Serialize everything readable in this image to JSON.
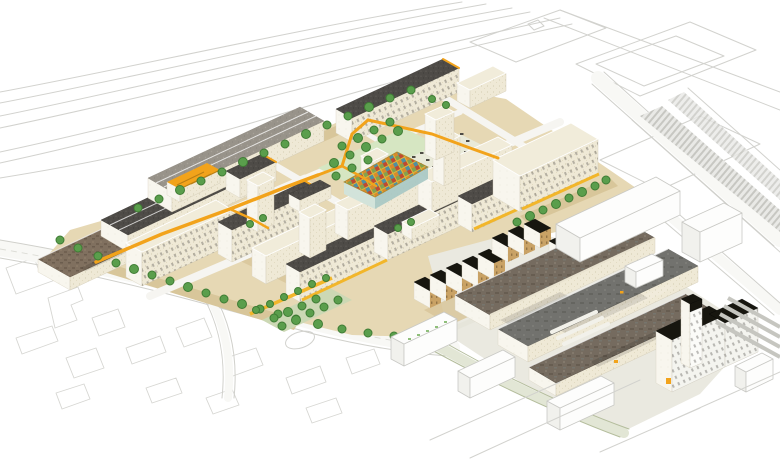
{
  "meta": {
    "image_type": "architectural-masterplan-axonometric-illustration",
    "description": "Aerial axonometric rendering of a proposed campus masterplan: rows of cream mid-rise blocks with charcoal and cream roofs, green courtyards and street trees, a winding amber elevated walkway, a multicoloured patchwork market-hall roof, retained industrial sheds with mottled brown and grey roofs to the south-east, a white tower block with black roof, and pale line-drawn context roads, motorway curves, car parks and building footprints around the edges."
  },
  "colors": {
    "background": "#ffffff",
    "context_line": "#d2d2ce",
    "ground_tan": "#e6d8b4",
    "ground_sand": "#d8c69a",
    "facade_cream": "#efe9d6",
    "facade_light": "#f8f6ee",
    "roof_charcoal": "#4e4b47",
    "roof_cream": "#f1ecda",
    "roof_gray": "#98938a",
    "roof_rust": "#80705f",
    "roof_black": "#17160f",
    "house_tan": "#c9a265",
    "tree_green": "#5a9e4c",
    "tree_edge": "#3f7c34",
    "lawn_green": "#d6e6c2",
    "paving_sage": "#ccd8b4",
    "walkway_amber": "#f2a31b",
    "arcade_yellow": "#f2b62a",
    "mosaic_yellow": "#ddb53a",
    "mosaic_red": "#bf4a31",
    "mosaic_orange": "#d98a2b",
    "mosaic_green": "#84a14e",
    "mosaic_teal": "#4f8fa0"
  },
  "scene": {
    "regions": [
      {
        "name": "motorway-corridor",
        "description": "sweeping curved carriageway outlines, top left"
      },
      {
        "name": "proposed-campus",
        "description": "coloured development: cream slab blocks, charcoal and cream roofs, courtyards, amber walkway, yellow arcades, street trees"
      },
      {
        "name": "market-hall",
        "description": "low central hall with multicoloured patchwork roof"
      },
      {
        "name": "solar-court",
        "description": "pale court with rows of dark photovoltaic panels"
      },
      {
        "name": "industrial-quarter",
        "description": "large retained sheds with mottled roofs, terraced workshop row with black roofs, white perimeter block and tower"
      },
      {
        "name": "context",
        "description": "pale outlined streets, parking lots, ghost massing and building footprints"
      }
    ]
  }
}
